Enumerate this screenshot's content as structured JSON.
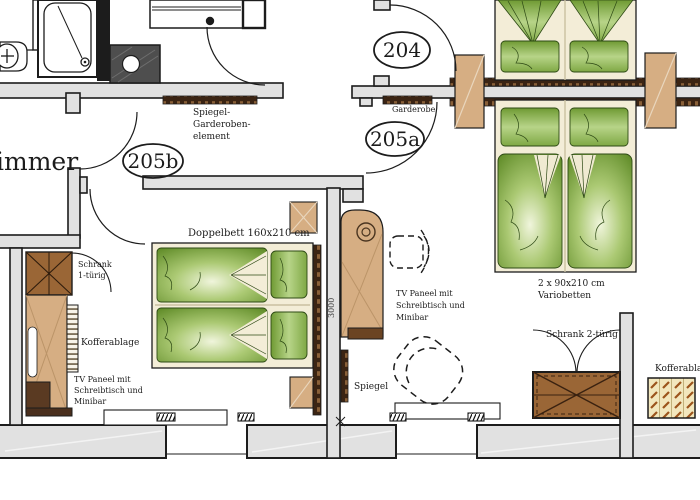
{
  "plan": {
    "title_note": "hotel floor plan",
    "rooms": {
      "room204": "204",
      "room205a": "205a",
      "room205b": "205b",
      "cut_room": "immer"
    },
    "labels": {
      "spiegel_garderoben_l1": "Spiegel-",
      "spiegel_garderoben_l2": "Garderoben-",
      "spiegel_garderoben_l3": "element",
      "garderobe": "Garderobe",
      "doppelbett": "Doppelbett 160x210 cm",
      "schrank1_l1": "Schrank",
      "schrank1_l2": "1-türig",
      "kofferablage_left": "Kofferablage",
      "tv_panel_l1": "TV Paneel mit",
      "tv_panel_l2": "Schreibtisch und",
      "tv_panel_l3": "Minibar",
      "spiegel": "Spiegel",
      "variobetten_l1": "2 x 90x210 cm",
      "variobetten_l2": "Variobetten",
      "schrank2": "Schrank 2-türig",
      "kofferablage_right": "Kofferablage",
      "dim_3000": "3000"
    },
    "colors": {
      "wall_fill": "#e1e1e1",
      "line": "#1c1c1c",
      "bed_frame": "#f3edd7",
      "duvet_green_dark": "#5e8a26",
      "duvet_green_light": "#f0f5dc",
      "furniture_tan": "#d6ae83",
      "furniture_brown": "#9a6636",
      "strip_dark_brown": "#3b2413",
      "luggage_bg": "#f2e7bd",
      "dark_fixture": "#4e4e4e"
    }
  }
}
